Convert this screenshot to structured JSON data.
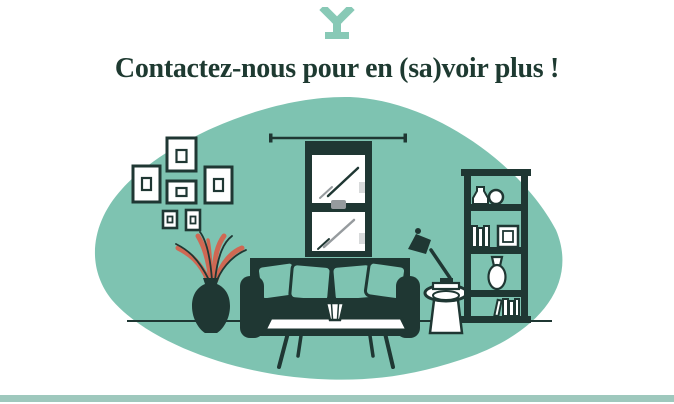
{
  "page": {
    "title": "Contactez-nous pour en (sa)voir plus !",
    "logo_icon": "y-pedestal-logo",
    "colors": {
      "background": "#ffffff",
      "heading": "#1e3a31",
      "teal": "#7ec3b1",
      "ink": "#1f3733",
      "coral": "#cf6853",
      "gray": "#969b9e",
      "light_gray": "#d8dadb",
      "white": "#ffffff",
      "footer_bar": "#9ec8bd",
      "logo": "#88c9b6"
    }
  },
  "illustration": {
    "name": "living-room-scene",
    "elements": [
      "organic-blob-background",
      "picture-frames-gallery",
      "plant-in-vase",
      "window-with-curtains",
      "sofa-with-pillows",
      "coffee-table-with-vase",
      "round-side-table",
      "desk-lamp",
      "bookshelf-with-books-and-vases",
      "floor-line"
    ]
  }
}
